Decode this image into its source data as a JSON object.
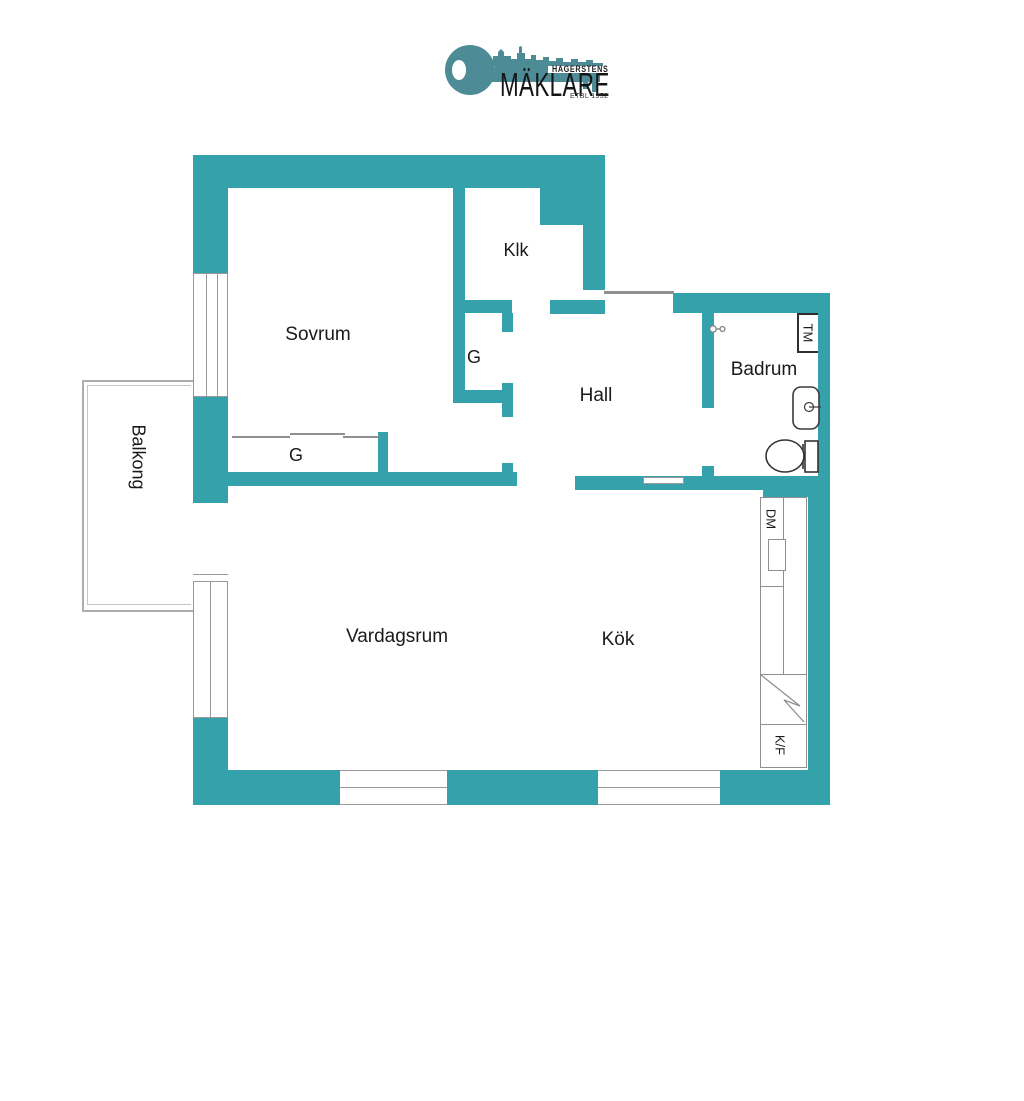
{
  "logo": {
    "brand_top": "HAGERSTENS",
    "brand_main": "MÄKLARE",
    "established": "ETBL 1952"
  },
  "rooms": {
    "bedroom": "Sovrum",
    "walkin_closet": "Klk",
    "closet_g_hall": "G",
    "closet_g_bedroom": "G",
    "hall": "Hall",
    "bathroom": "Badrum",
    "balcony": "Balkong",
    "living_room": "Vardagsrum",
    "kitchen": "Kök"
  },
  "appliances": {
    "washing_machine": "TM",
    "dishwasher": "DM",
    "fridge_freezer": "K/F"
  },
  "colors": {
    "wall_teal": "#35A1AA",
    "logo_teal": "#4D8C96",
    "thin_line_gray": "#8f8f8f",
    "text": "#1a1a1a"
  }
}
